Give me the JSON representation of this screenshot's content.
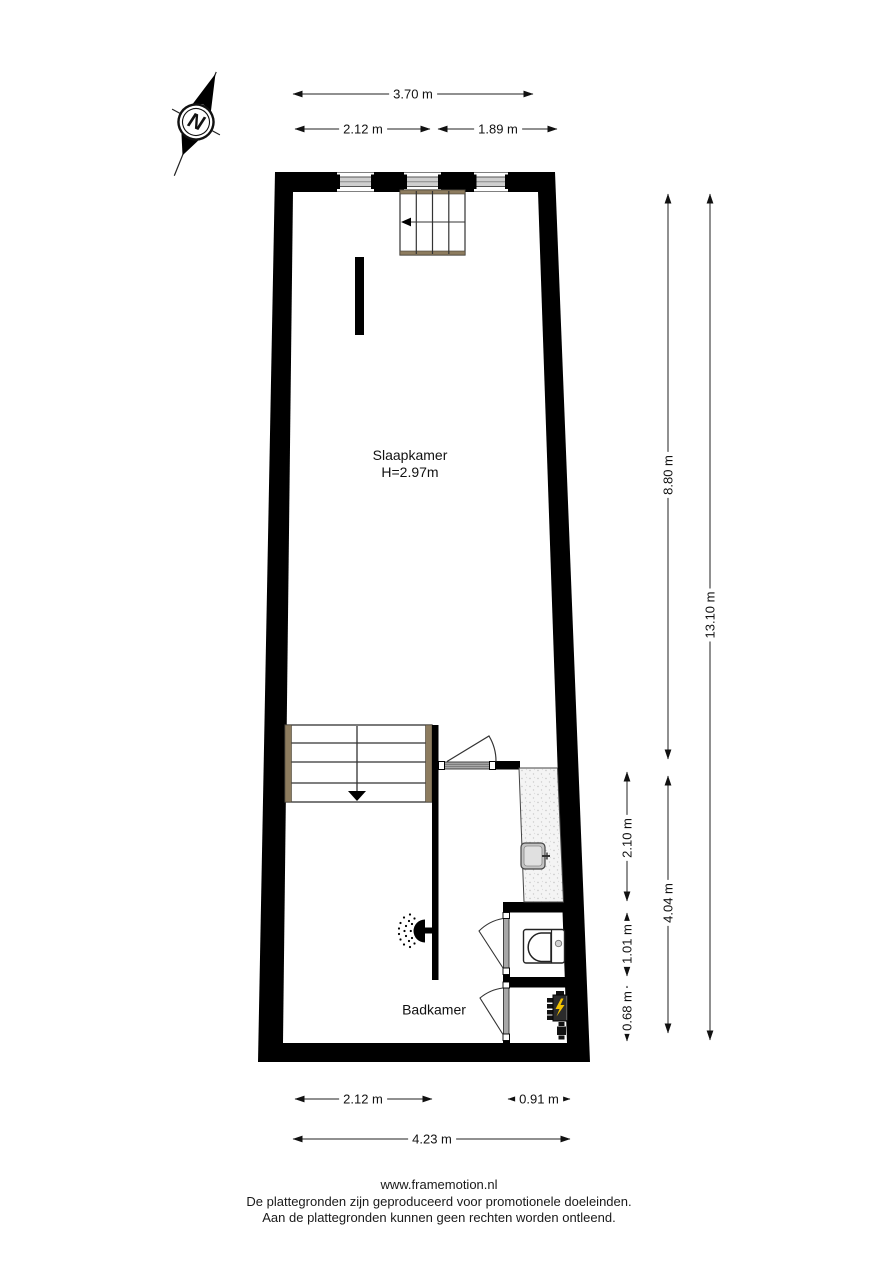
{
  "compass": {
    "label": "N"
  },
  "rooms": {
    "slaapkamer": {
      "name": "Slaapkamer",
      "ceiling_height": "H=2.97m"
    },
    "badkamer": {
      "name": "Badkamer"
    }
  },
  "dimensions": {
    "top": {
      "total": "3.70 m",
      "left": "2.12 m",
      "right": "1.89 m"
    },
    "right": {
      "upper": "8.80 m",
      "total": "13.10 m",
      "shower": "2.10 m",
      "toilet": "1.01 m",
      "closet": "0.68 m",
      "lower": "4.04 m"
    },
    "bottom": {
      "left": "2.12 m",
      "right": "0.91 m",
      "total": "4.23 m"
    }
  },
  "footer": {
    "website": "www.framemotion.nl",
    "disclaimer_line1": "De plattegronden zijn geproduceerd voor promotionele doeleinden.",
    "disclaimer_line2": "Aan de plattegronden kunnen geen rechten worden ontleend."
  },
  "icons": {
    "compass": "compass-north-arrow",
    "shower_head": "shower-head",
    "boiler": "electric-boiler",
    "toilet": "toilet-top-view",
    "sink": "wash-basin"
  },
  "colors": {
    "wall": "#000000",
    "stair_wood": "#8d7c5f",
    "boiler_accent": "#f2c200",
    "dimension_line": "#222222",
    "shower_floor": "#f2f2f2"
  }
}
